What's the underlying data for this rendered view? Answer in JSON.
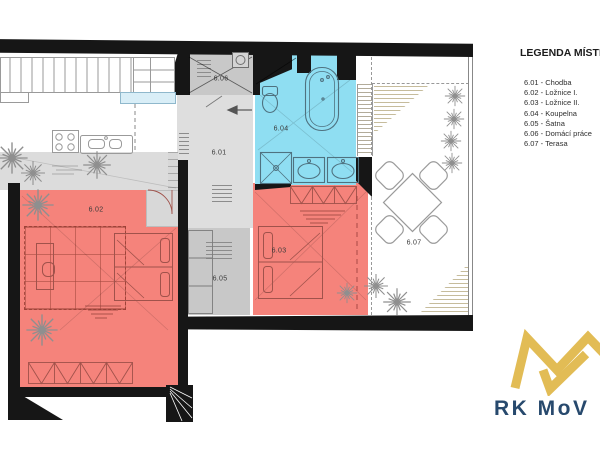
{
  "legend": {
    "title": "LEGENDA MÍSTNO",
    "entries": [
      "6.01 - Chodba",
      "6.02 - Ložnice I.",
      "6.03 - Ložnice II.",
      "6.04 - Koupelna",
      "6.05 - Šatna",
      "6.06 - Domácí práce",
      "6.07 - Terasa"
    ]
  },
  "plan": {
    "labels": {
      "hallway": "6.01",
      "bedroom_1": "6.02",
      "bedroom_2": "6.03",
      "bathroom": "6.04",
      "closet": "6.05",
      "utility": "6.06",
      "terrace": "6.07"
    }
  },
  "logo": {
    "brand": "RK MoV"
  },
  "colors": {
    "bedroom_fill": "#F5837B",
    "bathroom_fill": "#8FDEF2",
    "storage_fill": "#C8C8C8",
    "hallway_fill": "#DEDEDE",
    "wall": "#161616",
    "terrace_hatch": "#C6BC9C",
    "logo_gold": "#E2BC55",
    "logo_navy": "#27496D"
  }
}
